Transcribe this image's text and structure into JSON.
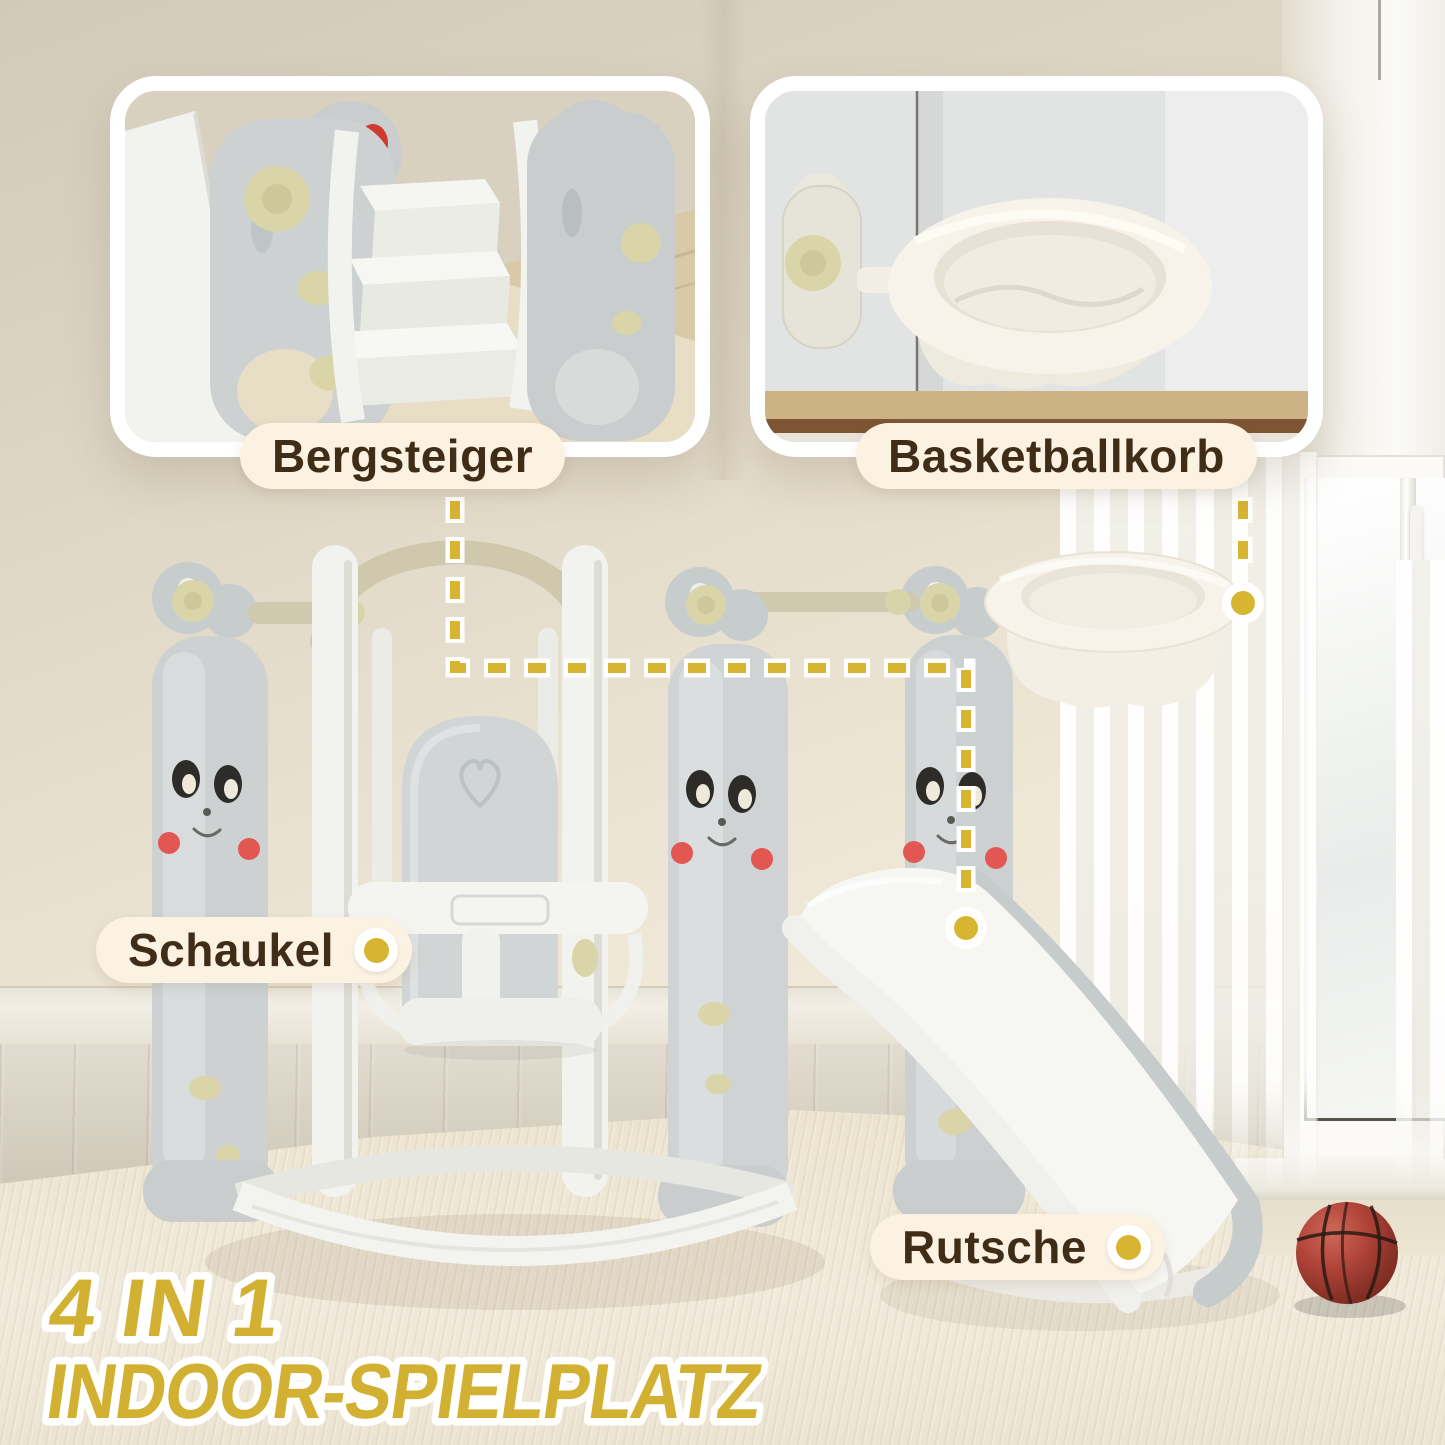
{
  "meta": {
    "kind": "product-marketing-image",
    "language": "de",
    "product": "4-in-1 indoor playground (swing, slide, basketball hoop, climber)"
  },
  "insets": {
    "left": {
      "label": "Bergsteiger",
      "depicts": "close-up of climber steps"
    },
    "right": {
      "label": "Basketballkorb",
      "depicts": "close-up of basketball hoop ring"
    }
  },
  "callouts": {
    "swing": {
      "label": "Schaukel"
    },
    "slide": {
      "label": "Rutsche"
    }
  },
  "title": {
    "line1": "4 IN 1",
    "line2": "INDOOR-SPIELPLATZ"
  },
  "icons": {
    "callout_marker": "yellow-dot",
    "connector": "yellow-dashed-line",
    "objects": [
      "swing-set",
      "slide",
      "basketball-hoop",
      "climber-steps",
      "basketball"
    ]
  },
  "colors": {
    "accent_yellow": "#d7b531",
    "title_yellow": "#d2b032",
    "label_background": "#fcf2e2",
    "label_text": "#402d17",
    "wall_beige": "#e6decd",
    "product_gray": "#cdd1d2",
    "product_white": "#f3f3f0",
    "tube_beige": "#cfc8ad",
    "accent_olive": "#d9d5a9",
    "cheek_red": "#e25752",
    "basketball_red": "#b2453a"
  }
}
